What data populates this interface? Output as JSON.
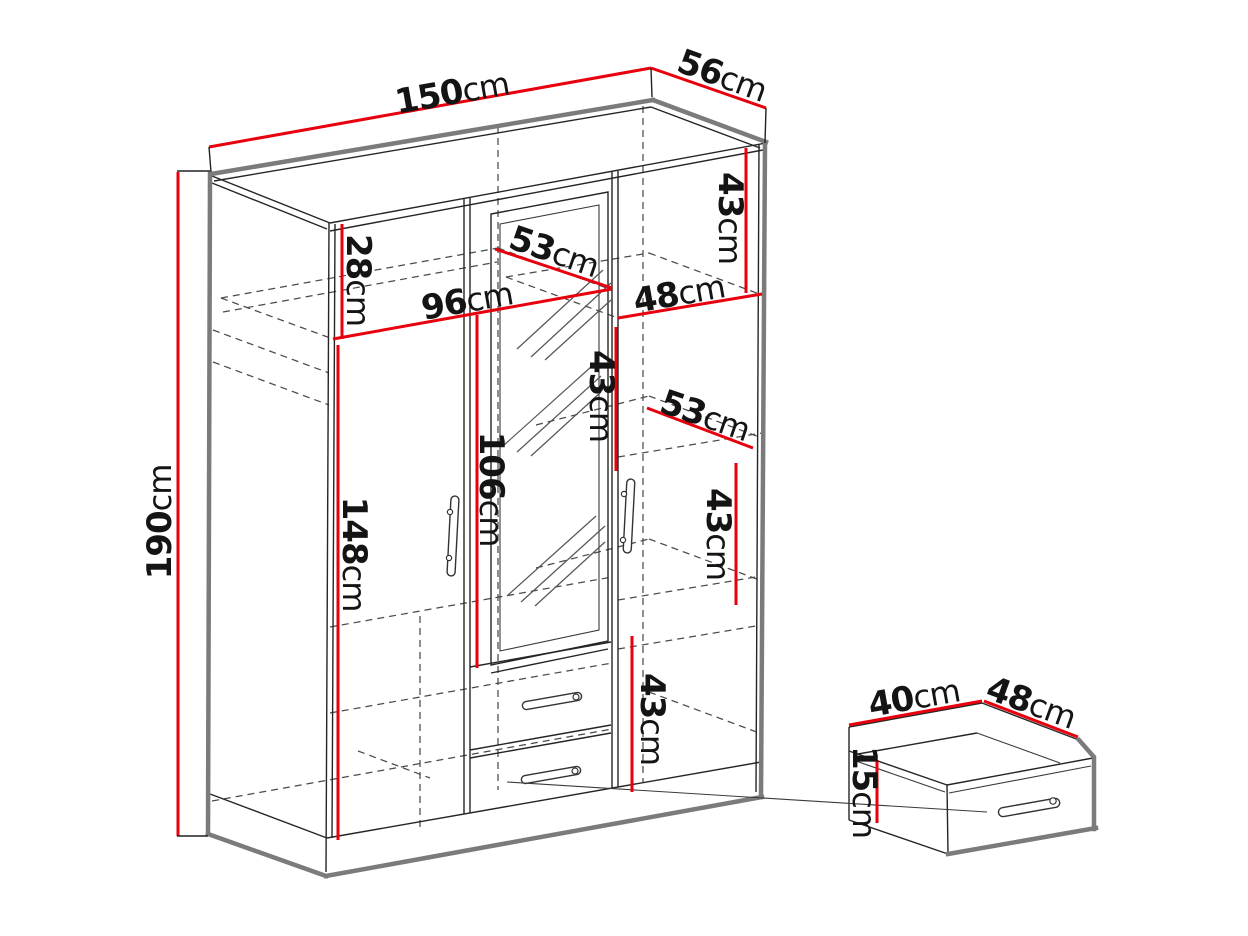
{
  "diagram": {
    "type": "furniture dimension diagram",
    "subject": "three-door wardrobe with mirror door and two drawers, plus enlarged drawer detail",
    "units": "cm",
    "colors": {
      "dimension_red": "#e8000d",
      "edge_gray": "#7b7b7b",
      "line_black": "#252525",
      "dashed_gray": "#4a4a4a",
      "background": "#ffffff"
    }
  },
  "wardrobe": {
    "overall": {
      "width": "150cm",
      "depth": "56cm",
      "height": "190cm"
    },
    "top_section": {
      "left_top_gap_height": "28cm",
      "left_shelf_width": "96cm",
      "top_shelf_depth": "53cm",
      "right_shelf_width": "48cm",
      "right_top_gap_height": "43cm"
    },
    "middle_section": {
      "right_gap_2_height": "43cm",
      "middle_shelf_depth": "53cm",
      "right_gap_3_height": "43cm",
      "mirror_door_height": "106cm",
      "left_door_height": "148cm"
    },
    "bottom_section": {
      "right_gap_4_height": "43cm"
    }
  },
  "drawer_detail": {
    "width": "40cm",
    "depth": "48cm",
    "height": "15cm"
  },
  "labels": [
    {
      "id": "overall-width",
      "value": "150",
      "unit": "cm"
    },
    {
      "id": "overall-depth",
      "value": "56",
      "unit": "cm"
    },
    {
      "id": "overall-height",
      "value": "190",
      "unit": "cm"
    },
    {
      "id": "top-left-gap",
      "value": "28",
      "unit": "cm"
    },
    {
      "id": "left-shelf-width",
      "value": "96",
      "unit": "cm"
    },
    {
      "id": "top-shelf-depth",
      "value": "53",
      "unit": "cm"
    },
    {
      "id": "right-shelf-width",
      "value": "48",
      "unit": "cm"
    },
    {
      "id": "right-gap-1",
      "value": "43",
      "unit": "cm"
    },
    {
      "id": "right-gap-2",
      "value": "43",
      "unit": "cm"
    },
    {
      "id": "middle-shelf-depth",
      "value": "53",
      "unit": "cm"
    },
    {
      "id": "right-gap-3",
      "value": "43",
      "unit": "cm"
    },
    {
      "id": "mirror-door-height",
      "value": "106",
      "unit": "cm"
    },
    {
      "id": "left-door-height",
      "value": "148",
      "unit": "cm"
    },
    {
      "id": "right-gap-4",
      "value": "43",
      "unit": "cm"
    },
    {
      "id": "drawer-width",
      "value": "40",
      "unit": "cm"
    },
    {
      "id": "drawer-depth",
      "value": "48",
      "unit": "cm"
    },
    {
      "id": "drawer-height",
      "value": "15",
      "unit": "cm"
    }
  ]
}
